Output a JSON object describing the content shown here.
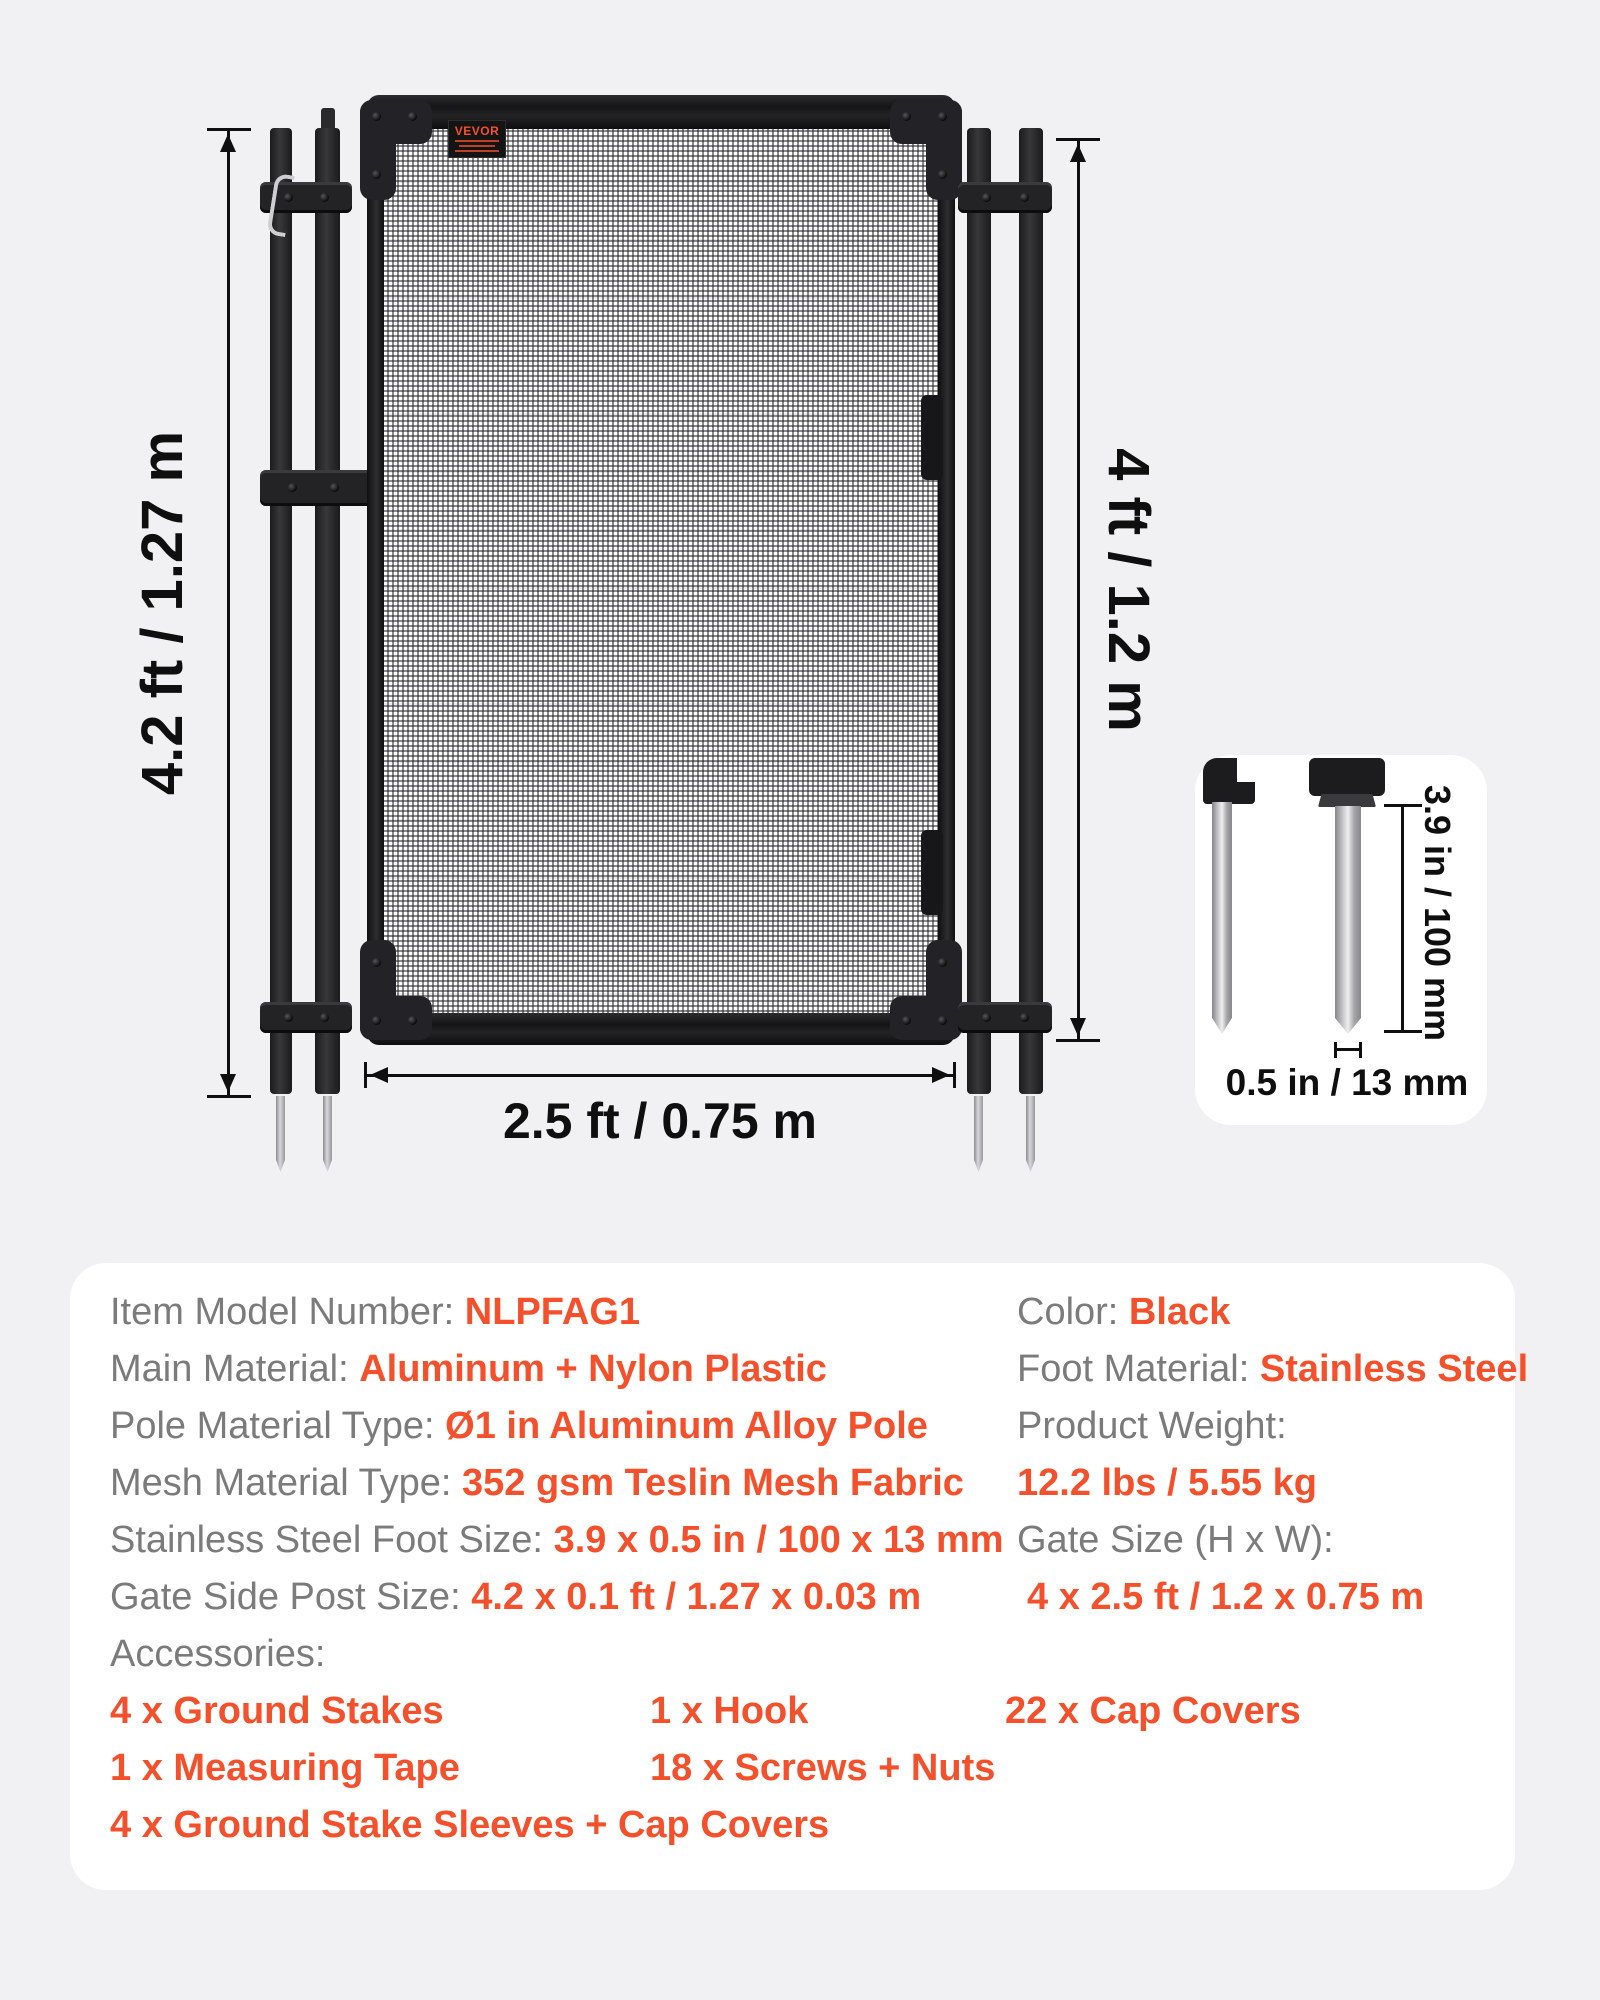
{
  "brand": {
    "label": "VEVOR"
  },
  "dimensions": {
    "post_height": "4.2 ft / 1.27 m",
    "gate_height": "4 ft / 1.2 m",
    "gate_width": "2.5 ft / 0.75 m",
    "stake_length": "3.9 in / 100 mm",
    "stake_diameter": "0.5 in / 13 mm"
  },
  "specs": {
    "left": [
      {
        "label": "Item Model Number: ",
        "value": "NLPFAG1"
      },
      {
        "label": "Main Material: ",
        "value": "Aluminum + Nylon Plastic"
      },
      {
        "label": "Pole Material Type: ",
        "value": "Ø1 in Aluminum Alloy Pole"
      },
      {
        "label": "Mesh Material Type: ",
        "value": "352 gsm Teslin Mesh Fabric"
      },
      {
        "label": "Stainless Steel Foot Size: ",
        "value": "3.9 x 0.5 in / 100 x 13 mm"
      },
      {
        "label": "Gate Side Post Size: ",
        "value": "4.2 x 0.1 ft / 1.27 x 0.03 m"
      }
    ],
    "accessories_label": "Accessories:",
    "accessories": [
      [
        "4 x Ground Stakes",
        "1 x Hook",
        "22 x Cap Covers"
      ],
      [
        "1 x Measuring Tape",
        "18 x Screws + Nuts"
      ],
      [
        "4 x Ground Stake Sleeves + Cap Covers"
      ]
    ],
    "right": [
      {
        "label": "Color: ",
        "value": "Black"
      },
      {
        "label": "Foot Material: ",
        "value": "Stainless Steel"
      },
      {
        "label": "Product Weight:",
        "value": ""
      },
      {
        "label": "",
        "value": "12.2 lbs / 5.55 kg"
      },
      {
        "label": "Gate Size (H x W):",
        "value": ""
      },
      {
        "label": "",
        "value": "4 x 2.5 ft / 1.2 x 0.75 m"
      }
    ]
  },
  "colors": {
    "accent": "#f4502c",
    "label_gray": "#7b7b7b",
    "ink": "#0f0f0f",
    "background": "#f1f1f3",
    "card": "#ffffff"
  }
}
